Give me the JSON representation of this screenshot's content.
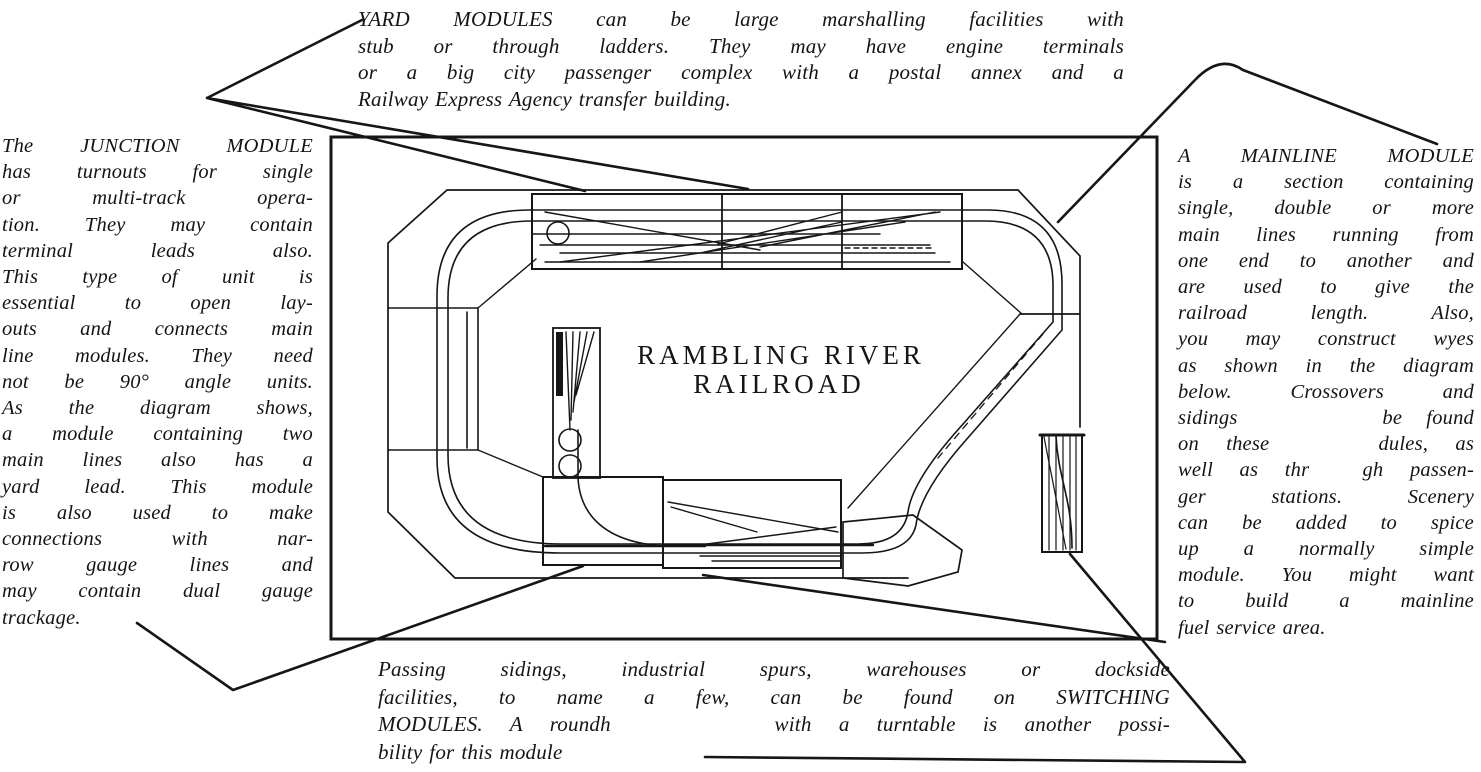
{
  "callouts": {
    "yard": {
      "lines": [
        "YARD MODULES can be large marshalling facilities with",
        "stub or through ladders. They may have engine terminals",
        "or a big city passenger complex with a postal annex and a",
        "Railway Express Agency transfer building."
      ]
    },
    "junction": {
      "lines": [
        "The JUNCTION MODULE",
        "has turnouts for single",
        "or multi-track opera-",
        "tion. They may contain",
        "terminal leads also.",
        "This type of unit is",
        "essential to open lay-",
        "outs and connects main",
        "line modules. They need",
        "not be 90° angle units.",
        "As the diagram shows,",
        "a module containing two",
        "main lines also has a",
        "yard lead. This module",
        "is also used to make",
        "connections with nar-",
        "row gauge lines and",
        "may contain dual gauge",
        "trackage."
      ]
    },
    "mainline": {
      "lines": [
        "A MAINLINE MODULE",
        "is a section containing",
        "single, double or more",
        "main lines running from",
        "one end to another and",
        "are used to give the",
        "railroad length. Also,",
        "you may construct wyes",
        "as shown in the diagram",
        "below. Crossovers and",
        "sidings      be found",
        "on these    dules, as",
        "well as thr  gh passen-",
        "ger stations. Scenery",
        "can be added to spice",
        "up a normally simple",
        "module. You might want",
        "to build a mainline",
        "fuel service area."
      ]
    },
    "switching": {
      "lines": [
        "Passing sidings, industrial spurs, warehouses or dockside",
        "facilities, to name a few, can be found on SWITCHING",
        "MODULES. A roundh      with a turntable is another possi-",
        "bility for this module"
      ]
    }
  },
  "diagram": {
    "title_line1": "RAMBLING RIVER",
    "title_line2": "RAILROAD"
  },
  "colors": {
    "ink": "#161616",
    "paper": "#ffffff"
  }
}
